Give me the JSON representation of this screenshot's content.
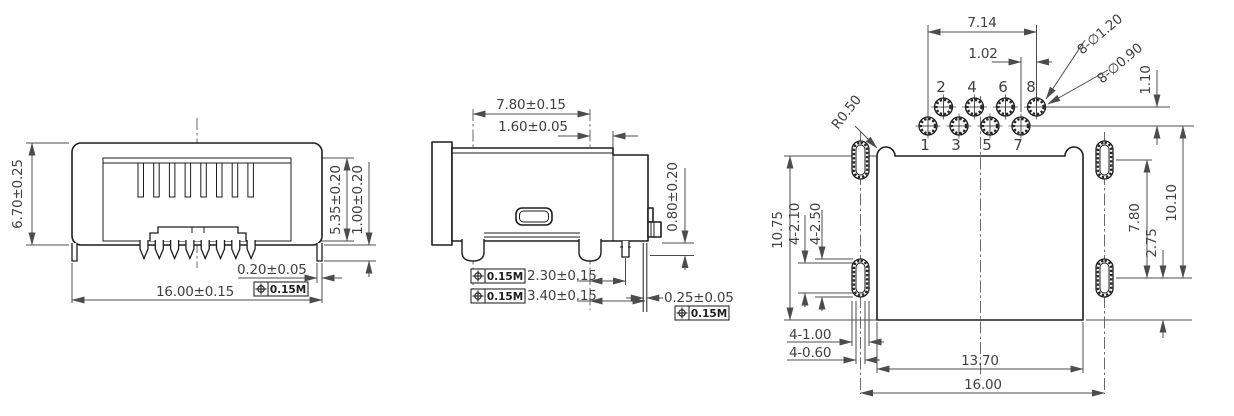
{
  "colors": {
    "background": "#ffffff",
    "part_line": "#1d1d1d",
    "dimension_line": "#4c4c4c",
    "text": "#3f3f3f"
  },
  "tolerance": {
    "symbol_icon": "position-tolerance-icon",
    "value": "0.15M"
  },
  "front_view": {
    "height": "6.70±0.25",
    "width": "16.00±0.15",
    "shield_tab_width": "0.20±0.05",
    "opening_height": "5.35±0.20",
    "leg_protrusion": "1.00±0.20"
  },
  "side_view": {
    "post_span": "7.80±0.15",
    "edge_offset": "1.60±0.05",
    "tab_height": "0.80±0.20",
    "pin_row_1": "2.30±0.15",
    "pin_row_2": "3.40±0.15",
    "pin_thickness": "0.25±0.05"
  },
  "footprint_view": {
    "pin_span": "7.14",
    "pin_stagger": "1.02",
    "pad_callout": "8-∅1.20",
    "hole_callout": "8-∅0.90",
    "row_gap": "1.10",
    "corner_radius": "R0.50",
    "left_height": "10.75",
    "slot_length": "4-2.10",
    "pad_length": "4-2.50",
    "pad_column_span": "7.80",
    "pad_to_edge": "2.75",
    "overall_height": "10.10",
    "pad_width": "4-1.00",
    "slot_width": "4-0.60",
    "body_width": "13.70",
    "overall_width": "16.00",
    "pin_labels": [
      "1",
      "2",
      "3",
      "4",
      "5",
      "6",
      "7",
      "8"
    ]
  }
}
